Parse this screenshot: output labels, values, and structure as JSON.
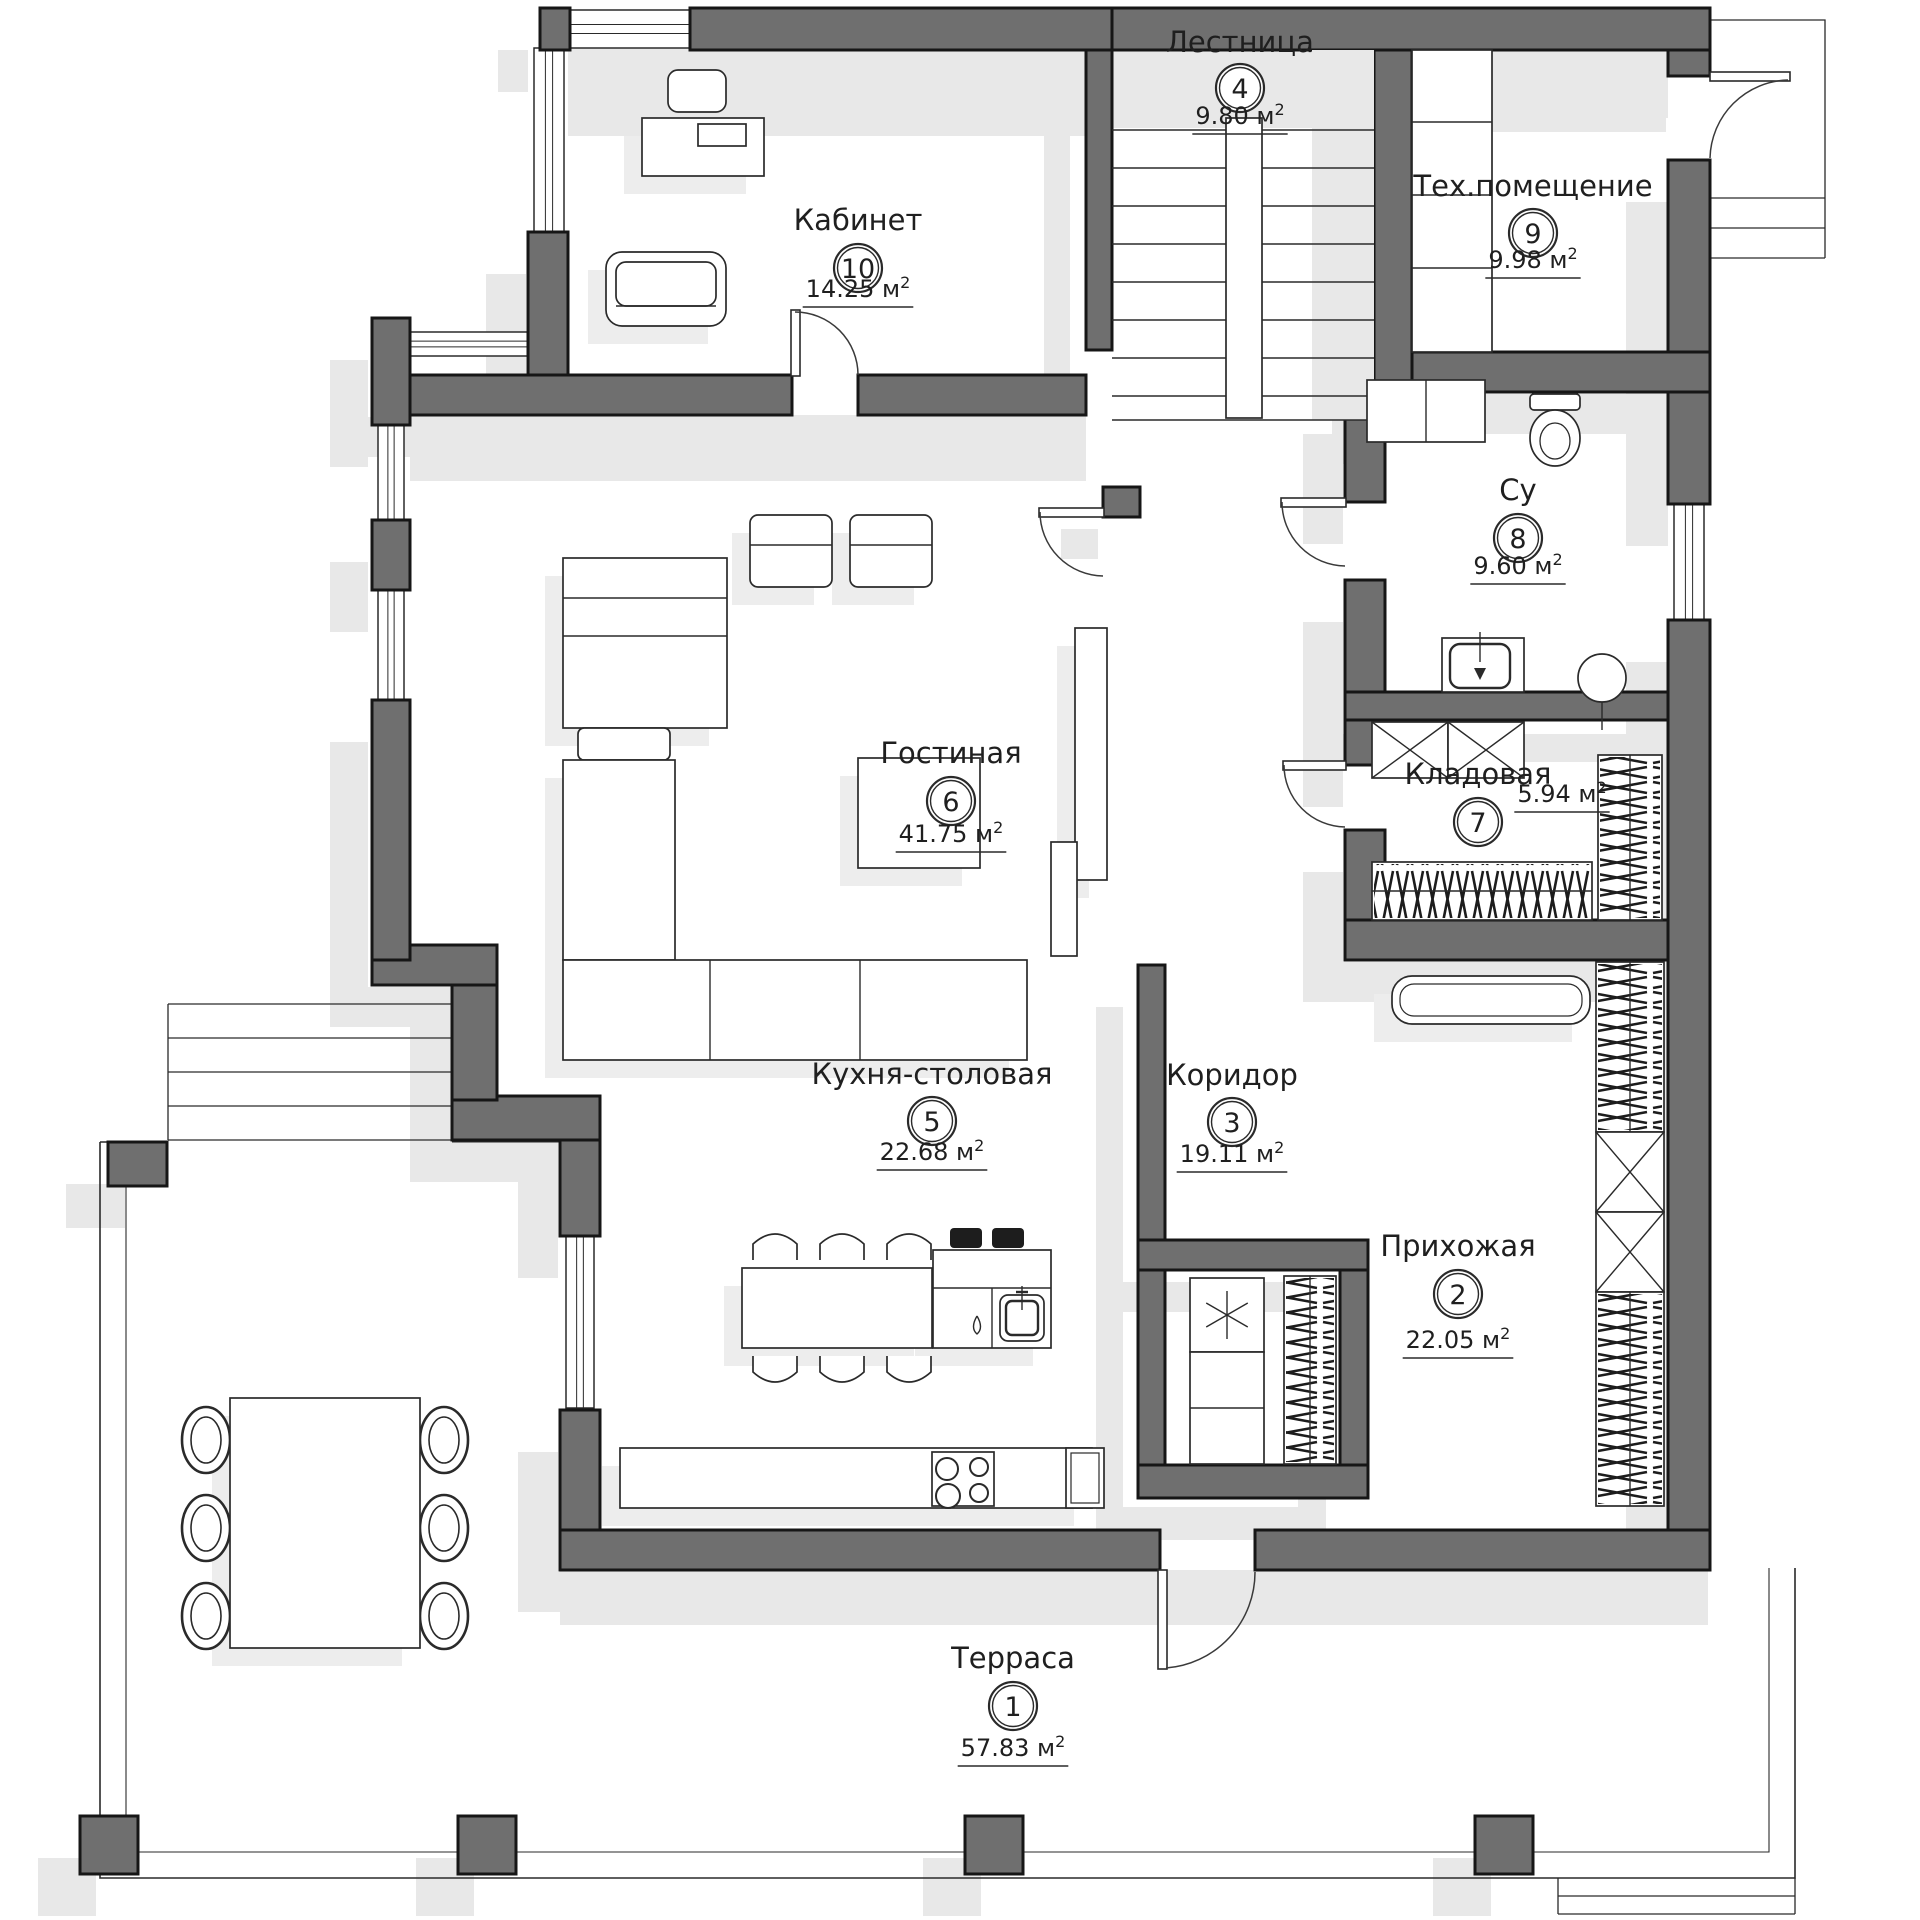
{
  "plan": {
    "language": "ru",
    "unit": "м",
    "unit_sup": "2",
    "rooms": [
      {
        "number": "1",
        "name": "Терраса",
        "area": "57.83",
        "x": 1013,
        "name_y": 1668,
        "circle_y": 1706,
        "area_y": 1756
      },
      {
        "number": "2",
        "name": "Прихожая",
        "area": "22.05",
        "x": 1458,
        "name_y": 1256,
        "circle_y": 1294,
        "area_y": 1348
      },
      {
        "number": "3",
        "name": "Коридор",
        "area": "19.11",
        "x": 1232,
        "name_y": 1085,
        "circle_y": 1122,
        "area_y": 1162
      },
      {
        "number": "4",
        "name": "Лестница",
        "area": "9.80",
        "x": 1240,
        "name_y": 52,
        "circle_y": 88,
        "area_y": 124
      },
      {
        "number": "5",
        "name": "Кухня-столовая",
        "area": "22.68",
        "x": 932,
        "name_y": 1084,
        "circle_y": 1121,
        "area_y": 1160
      },
      {
        "number": "6",
        "name": "Гостиная",
        "area": "41.75",
        "x": 951,
        "name_y": 763,
        "circle_y": 801,
        "area_y": 842
      },
      {
        "number": "7",
        "name": "Кладовая",
        "area": "5.94",
        "x": 1478,
        "name_y": 784,
        "circle_y": 822,
        "area_x": 1562,
        "area_y": 802
      },
      {
        "number": "8",
        "name": "Су",
        "area": "9.60",
        "x": 1518,
        "name_y": 500,
        "circle_y": 538,
        "area_y": 574
      },
      {
        "number": "9",
        "name": "Тех.помещение",
        "area": "9.98",
        "x": 1533,
        "name_y": 196,
        "circle_y": 233,
        "area_y": 268
      },
      {
        "number": "10",
        "name": "Кабинет",
        "area": "14.25",
        "x": 858,
        "name_y": 230,
        "circle_y": 268,
        "area_y": 297
      }
    ],
    "colors": {
      "wall_fill": "#6f6f6f",
      "wall_stroke": "#161616",
      "shadow": "#e8e8e8",
      "furniture_shadow": "#ededed",
      "line": "#2a2a2a",
      "paper": "#ffffff",
      "stool_fill": "#1d1d1d"
    }
  }
}
